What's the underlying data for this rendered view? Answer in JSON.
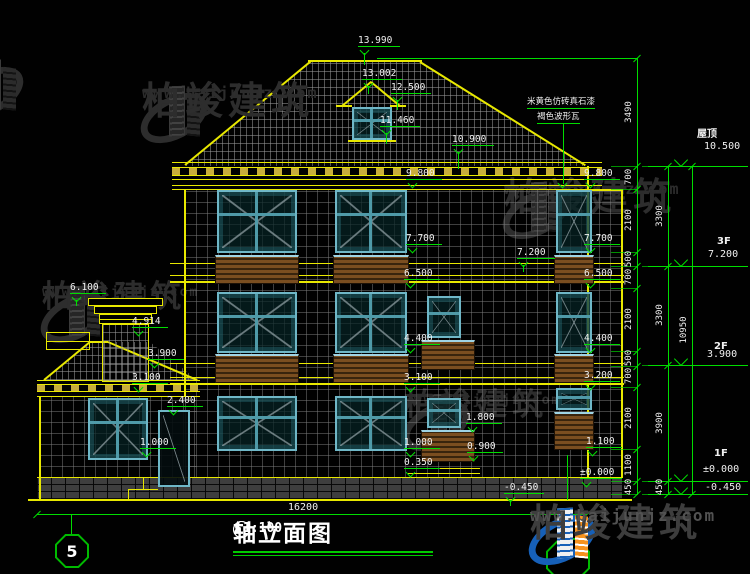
{
  "title": {
    "axis_start": "5",
    "dash": "-",
    "axis_end": "1",
    "text": "轴立面图",
    "scale": "1:100"
  },
  "axis_bubble": "5",
  "bottom_dim": {
    "text": "16200"
  },
  "material_note": {
    "line1": "米黄色仿砖真石漆",
    "line2": "褐色波形瓦"
  },
  "watermark": {
    "name": "柏竣建筑",
    "url": "www.baijunjz.com"
  },
  "elevation_markers": [
    {
      "t": "13.990",
      "x": 358,
      "y": 36,
      "w": 42,
      "stem": 12
    },
    {
      "t": "13.002",
      "x": 362,
      "y": 69,
      "w": 40,
      "stem": 8
    },
    {
      "t": "12.500",
      "x": 391,
      "y": 83,
      "w": 40,
      "stem": 10
    },
    {
      "t": "11.460",
      "x": 380,
      "y": 116,
      "w": 40,
      "stem": 11
    },
    {
      "t": "10.900",
      "x": 452,
      "y": 135,
      "w": 42,
      "stem": 17
    },
    {
      "t": "9.800",
      "x": 406,
      "y": 169,
      "w": 36
    },
    {
      "t": "9.800",
      "x": 584,
      "y": 169,
      "w": 36
    },
    {
      "t": "7.700",
      "x": 406,
      "y": 234,
      "w": 36
    },
    {
      "t": "7.700",
      "x": 584,
      "y": 234,
      "w": 36
    },
    {
      "t": "7.200",
      "x": 517,
      "y": 248,
      "w": 38,
      "stem": 7
    },
    {
      "t": "6.500",
      "x": 404,
      "y": 269,
      "w": 36
    },
    {
      "t": "6.500",
      "x": 584,
      "y": 269,
      "w": 36
    },
    {
      "t": "4.400",
      "x": 404,
      "y": 334,
      "w": 36
    },
    {
      "t": "4.400",
      "x": 584,
      "y": 334,
      "w": 36
    },
    {
      "t": "6.100",
      "x": 70,
      "y": 283,
      "w": 36,
      "stem": 6
    },
    {
      "t": "4.914",
      "x": 132,
      "y": 317,
      "w": 36
    },
    {
      "t": "3.900",
      "x": 148,
      "y": 349,
      "w": 36
    },
    {
      "t": "3.100",
      "x": 132,
      "y": 373,
      "w": 36
    },
    {
      "t": "3.100",
      "x": 404,
      "y": 373,
      "w": 36
    },
    {
      "t": "3.200",
      "x": 584,
      "y": 371,
      "w": 36
    },
    {
      "t": "2.400",
      "x": 167,
      "y": 396,
      "w": 36
    },
    {
      "t": "1.800",
      "x": 466,
      "y": 413,
      "w": 36
    },
    {
      "t": "1.000",
      "x": 140,
      "y": 438,
      "w": 36
    },
    {
      "t": "1.000",
      "x": 404,
      "y": 438,
      "w": 36
    },
    {
      "t": "0.900",
      "x": 467,
      "y": 442,
      "w": 36
    },
    {
      "t": "0.350",
      "x": 404,
      "y": 458,
      "w": 36
    },
    {
      "t": "1.100",
      "x": 586,
      "y": 437,
      "w": 36
    },
    {
      "t": "±0.000",
      "x": 580,
      "y": 468,
      "w": 42
    },
    {
      "t": "-0.450",
      "x": 504,
      "y": 483,
      "w": 40,
      "stem": 6
    }
  ],
  "floor_levels": [
    {
      "label": "屋顶",
      "value": "10.500",
      "lx": 697,
      "lyt": 125,
      "vx": 704,
      "vyt": 141,
      "line_y": 166
    },
    {
      "label": "3F",
      "value": "7.200",
      "lx": 717,
      "lyt": 236,
      "vx": 708,
      "vyt": 249,
      "line_y": 266
    },
    {
      "label": "2F",
      "value": "3.900",
      "lx": 714,
      "lyt": 341,
      "vx": 707,
      "vyt": 349,
      "line_y": 365
    },
    {
      "label": "1F",
      "value": "±0.000",
      "lx": 714,
      "lyt": 448,
      "vx": 703,
      "vyt": 464,
      "line_y": 481
    },
    {
      "label": "",
      "value": "-0.450",
      "lx": 0,
      "lyt": 0,
      "vx": 705,
      "vyt": 482,
      "line_y": 494
    }
  ],
  "dim_columns": [
    {
      "x": 637,
      "y1": 58,
      "y2": 495,
      "ticks": [
        58,
        166,
        189,
        252,
        266,
        288,
        351,
        366,
        387,
        449,
        481,
        494
      ],
      "labels": [
        {
          "t": "3490",
          "y": 112
        },
        {
          "t": "700",
          "y": 177
        },
        {
          "t": "2100",
          "y": 220
        },
        {
          "t": "500",
          "y": 259
        },
        {
          "t": "700",
          "y": 277
        },
        {
          "t": "2100",
          "y": 319
        },
        {
          "t": "500",
          "y": 358
        },
        {
          "t": "700",
          "y": 376
        },
        {
          "t": "2100",
          "y": 418
        },
        {
          "t": "1100",
          "y": 465
        },
        {
          "t": "450",
          "y": 487
        }
      ]
    },
    {
      "x": 668,
      "y1": 166,
      "y2": 495,
      "ticks": [
        166,
        266,
        365,
        481,
        494
      ],
      "labels": [
        {
          "t": "3300",
          "y": 216
        },
        {
          "t": "3300",
          "y": 315
        },
        {
          "t": "3900",
          "y": 423
        },
        {
          "t": "450",
          "y": 487
        }
      ]
    },
    {
      "x": 692,
      "y1": 166,
      "y2": 495,
      "ticks": [
        166,
        494
      ],
      "labels": [
        {
          "t": "10950",
          "y": 330
        }
      ]
    }
  ],
  "colors": {
    "line_green": "#00dd00",
    "line_yellow": "#e8e800",
    "text_white": "#f0f0f0",
    "window_frame": "#6fb7c7",
    "shutter_brown": "#7a4e20",
    "logo_blue": "#1660b8",
    "logo_orange": "#f6921e"
  }
}
